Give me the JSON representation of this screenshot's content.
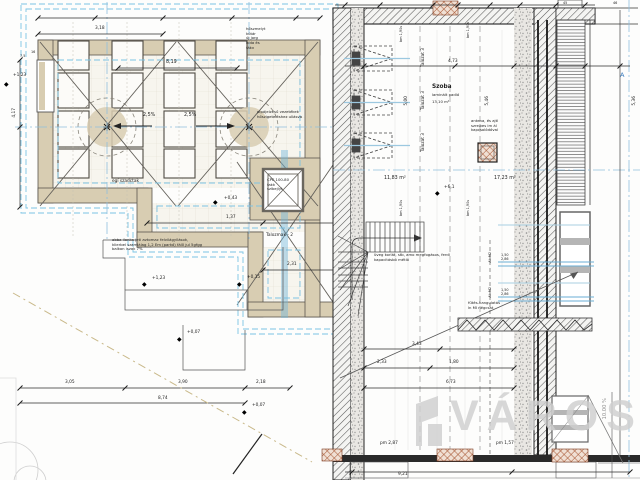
{
  "drawing_type": "architectural floor plan section",
  "colors": {
    "wall_tan": "#d8cdb2",
    "insulation_cyan": "#7cc4e4",
    "axis_blue": "#8fbfdd",
    "brick_red": "#a34f2a",
    "watermark_gray": "#d0d0d0",
    "line_dark": "#333333"
  },
  "icons": {
    "elev_marker": "◆"
  },
  "watermark": {
    "text": "VÁROSI"
  },
  "texts": {
    "note_tl": "hőszmelyt\nkútár\núj jorg\nhída és\nfákv",
    "note_pipe": "pipájelzésű vezetékek\nhőszigeteléshez ullásva",
    "note_cpe": "CPE 100-80\nfakk\nszíbejlyt",
    "note_boiler": "abba ilonka jeti avtomac felvilágyílások,\nklierbel szamlálag 1,2 Em (parkó) fál0 jul 5gfgg\nbalkon iszak 7%",
    "note_glass": "üveg korlát, stb, amo megfogásos, ferdl\nkapacitásbó métló",
    "note_ant": "antena, és ajtl\nszrelkes im ál\nkapcsolódóval",
    "note_futes": "fűtés-hangulatás\nln MI négcsat",
    "note_egi": "egí szadctak",
    "note_taloz2": "Talozmak - 2",
    "room_name": "Szoba",
    "room_floor": "laminált padló",
    "room_area": "13,10 m²",
    "area_1183": "11,83 m²",
    "area_1723": "17,23 m²",
    "talozat": "Talozat 3",
    "bm190": "bm 1,90s",
    "ab_m2": "Ab M2",
    "win_dims": "1,50\n2,86",
    "slope_left": "2,5%",
    "slope_right": "2,5%",
    "slope_10": "10.00 %",
    "marker_a": "A",
    "dim_318": "3,18",
    "dim_819": "8,19",
    "dim_75": "7,5",
    "dim_16": "16",
    "dim_417": "4,17",
    "dim_137": "1,37",
    "dim_231": "2,31",
    "dim_305": "3,05",
    "dim_390": "3,90",
    "dim_218": "2,18",
    "dim_874": "8,74",
    "dim_473": "4,73",
    "dim_546": "5,46",
    "dim_500": "5,00",
    "dim_343": "3,43",
    "dim_233": "2,33",
    "dim_180": "1,80",
    "dim_673": "6,73",
    "dim_921": "9,21",
    "dim_536": "5,36",
    "dim_46": "46",
    "dim_45": "45",
    "pm_287": "pm 2,87",
    "pm_157": "pm 1,57",
    "elev_123": "+1,23",
    "elev_043": "+0,43",
    "elev_015": "+0,15",
    "elev_007": "+0,07",
    "elev_61": "+6,1"
  }
}
